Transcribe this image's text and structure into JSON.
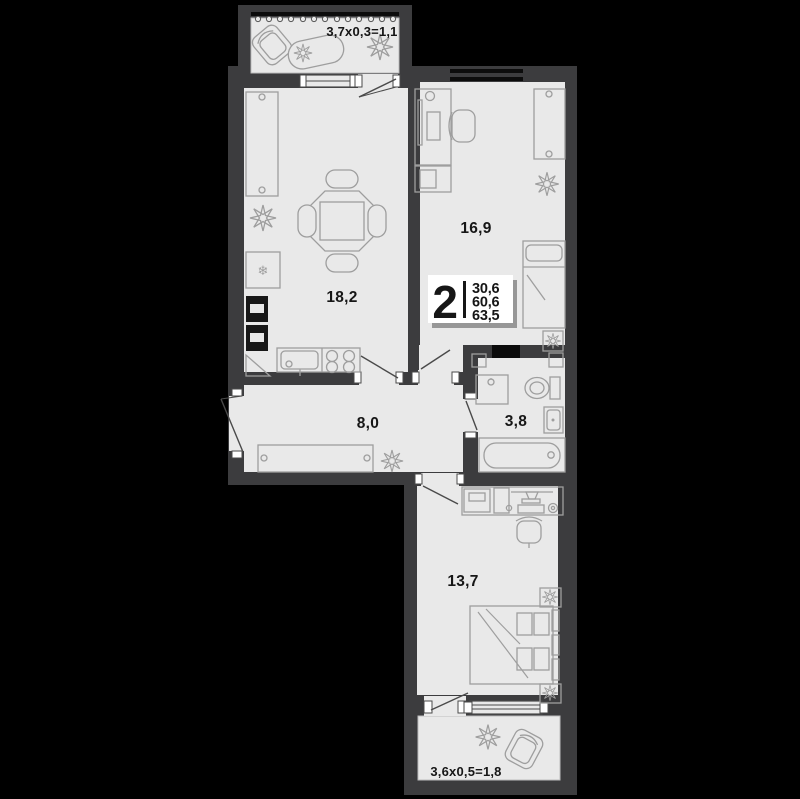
{
  "plan": {
    "badge": {
      "rooms_count": "2",
      "area_living": "30,6",
      "area_main": "60,6",
      "area_total": "63,5"
    },
    "rooms": {
      "kitchen_living": {
        "area": "18,2"
      },
      "bedroom_upper": {
        "area": "16,9"
      },
      "hallway": {
        "area": "8,0"
      },
      "bathroom": {
        "area": "3,8"
      },
      "bedroom_lower": {
        "area": "13,7"
      },
      "balcony_upper": {
        "dims": "3,7x0,3=1,1"
      },
      "balcony_lower": {
        "dims": "3,6x0,5=1,8"
      }
    },
    "icons": {
      "fridge_snowflake": "❄"
    },
    "colors": {
      "background": "#000000",
      "wall": "#3c3c3e",
      "floor": "#e9e9e9",
      "furniture_line": "#9e9e9e",
      "accent_black": "#111111",
      "badge_bg": "#ffffff"
    }
  }
}
